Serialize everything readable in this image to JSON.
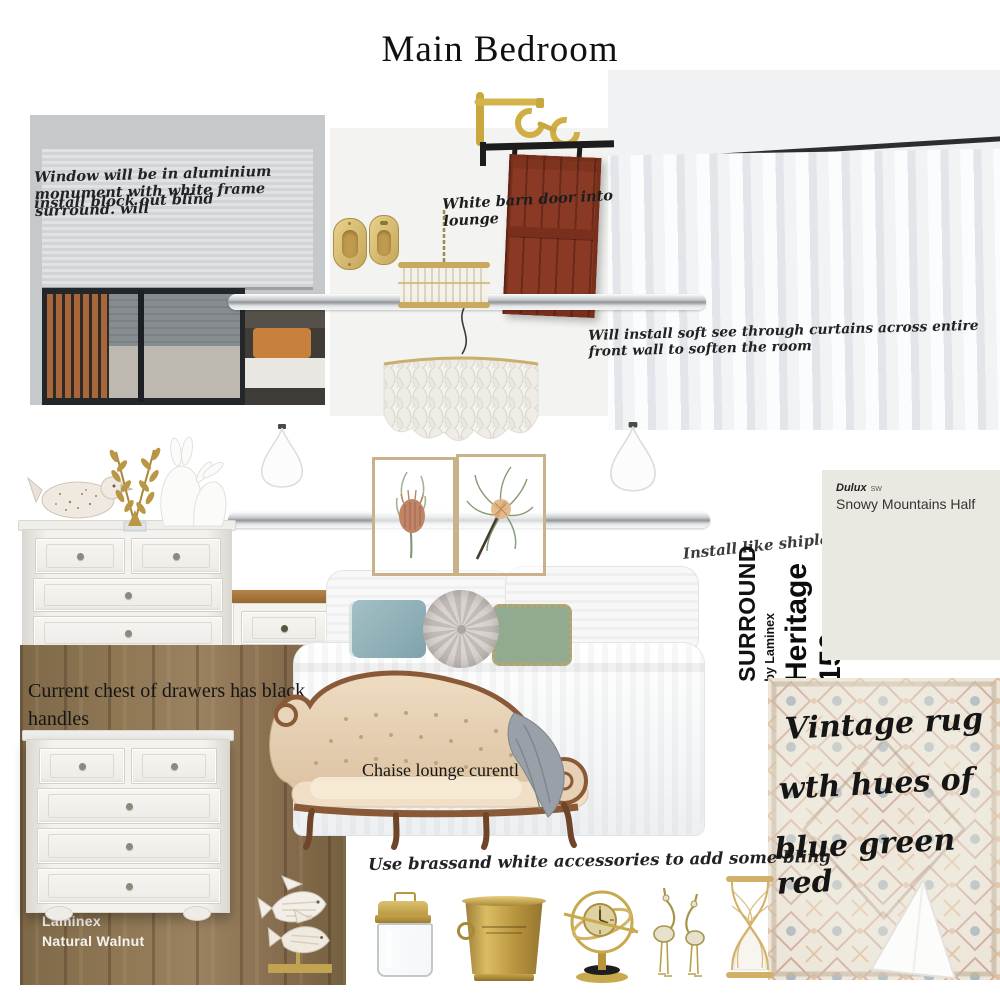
{
  "title": "Main Bedroom",
  "annotations": {
    "window_note_line1": "Window will be in aluminium monument with white frame surround.  will",
    "window_note_line2": "install block out blind",
    "barn_door_note": "White barn door into lounge",
    "curtain_note": "Will install soft see through curtains across entire front wall to soften the room",
    "shiplap_note": "Install like shiplap",
    "chest_note_line1": "Current chest of drawers has black",
    "chest_note_line2": "handles",
    "chaise_note": "Chaise lounge curentl",
    "accessories_note": "Use brassand white accessories to add some bling",
    "rug_note_line1": "Vintage rug",
    "rug_note_line2": "wth hues of",
    "rug_note_line3": "blue green red"
  },
  "products": {
    "paint_swatch": {
      "brand": "Dulux",
      "code": "SW",
      "name": "Snowy Mountains Half"
    },
    "wall_panel": {
      "brand": "SURROUND",
      "byline": "by Laminex",
      "model": "Heritage 150"
    },
    "timber": {
      "brand": "Laminex",
      "name": "Natural Walnut"
    }
  },
  "colors": {
    "paint_swatch": "#e9e9e1",
    "timber_walnut": "#8f7754",
    "barn_door": "#8a3a24",
    "brass": "#c8a94e",
    "pillow_blue": "#8fb3ba",
    "pillow_green": "#92ab90",
    "chaise_upholstery": "#e6d0b6"
  }
}
